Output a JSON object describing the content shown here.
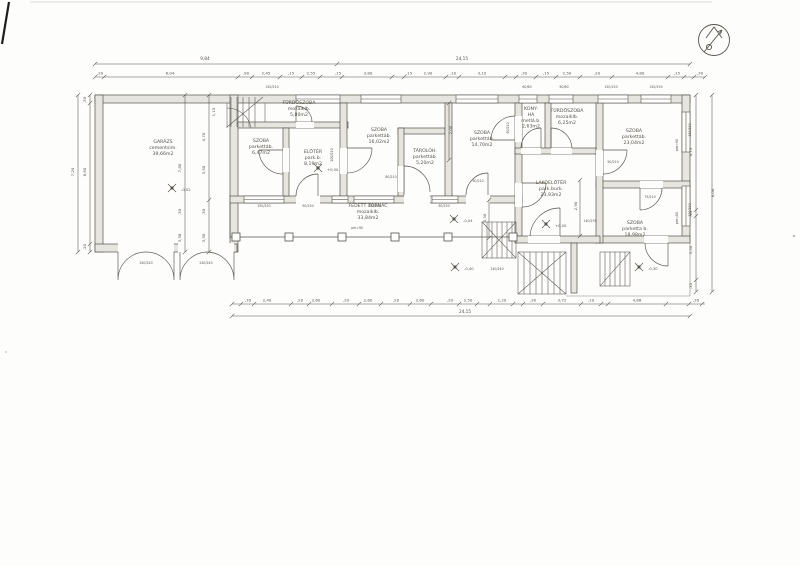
{
  "document": {
    "kind": "scanned architectural floor plan",
    "language": "hu"
  },
  "colors": {
    "ink": "#57534b",
    "ink_light": "#949087",
    "wall_fill": "#e6e5df",
    "paper": "#fdfdfc"
  },
  "compass": {
    "icon": "north-arrow"
  },
  "plan": {
    "rooms": [
      {
        "id": "garazs",
        "label": "GARÁZS\ncementsim.\n39,66m2",
        "x": 163,
        "y": 143
      },
      {
        "id": "furdoszoba1",
        "label": "FÜRDŐSZOBA\nmozaiklb.\n5,80m2",
        "x": 299,
        "y": 104
      },
      {
        "id": "szoba1",
        "label": "SZOBA\nparkettáb.\n6,47m2",
        "x": 261,
        "y": 142
      },
      {
        "id": "eloter",
        "label": "ELŐTÉR\npark.b.\n8,19m2",
        "x": 313,
        "y": 153
      },
      {
        "id": "szoba2",
        "label": "SZOBA\nparkettáb.\n16,02m2",
        "x": 379,
        "y": 131
      },
      {
        "id": "taroloh",
        "label": "TÁROLÓH.\nparkettáb.\n5,20m2",
        "x": 425,
        "y": 152
      },
      {
        "id": "szoba3",
        "label": "SZOBA\nparkettáb.\n14,70m2",
        "x": 482,
        "y": 134
      },
      {
        "id": "konyha",
        "label": "KONY-\nHA\nmetlá.b.\n2,63m2",
        "x": 531,
        "y": 110
      },
      {
        "id": "furdoszoba2",
        "label": "FÜRDŐSZOBA\nmozaiklb.\n6,25m2",
        "x": 567,
        "y": 112
      },
      {
        "id": "szoba4",
        "label": "SZOBA\nparkettáb.\n23,04m2",
        "x": 634,
        "y": 132
      },
      {
        "id": "lakoeloter",
        "label": "LAKÓELŐTÉR\npark.burk.\n23,93m2",
        "x": 551,
        "y": 184
      },
      {
        "id": "szoba5",
        "label": "SZOBA\nparketta b.\n18,98m2",
        "x": 635,
        "y": 224
      },
      {
        "id": "tornac",
        "label": "FEDETT TORNÁC\nmozaiklb.\n\n33,84m2",
        "x": 368,
        "y": 207
      }
    ],
    "levels": [
      {
        "t": "+0,00",
        "x": 326,
        "y": 170
      },
      {
        "t": "+0,00",
        "x": 554,
        "y": 226
      },
      {
        "t": "-0,04",
        "x": 462,
        "y": 221
      },
      {
        "t": "-0,40",
        "x": 463,
        "y": 269
      },
      {
        "t": "-0,30",
        "x": 647,
        "y": 269
      },
      {
        "t": "-0,02",
        "x": 180,
        "y": 190
      }
    ],
    "dim_labels": [
      {
        "t": "9,84",
        "x": 205,
        "y": 60,
        "s": 4.3
      },
      {
        "t": "24,15",
        "x": 462,
        "y": 60,
        "s": 4.3
      },
      {
        "t": ",20",
        "x": 100,
        "y": 74.5
      },
      {
        "t": "6,04",
        "x": 170,
        "y": 74.5
      },
      {
        "t": ",90",
        "x": 246,
        "y": 74.5
      },
      {
        "t": "2,45",
        "x": 266,
        "y": 74.5
      },
      {
        "t": ",15",
        "x": 291,
        "y": 74.5
      },
      {
        "t": "2,55",
        "x": 311,
        "y": 74.5
      },
      {
        "t": ",15",
        "x": 338,
        "y": 74.5
      },
      {
        "t": "3,80",
        "x": 368,
        "y": 74.5
      },
      {
        "t": ",15",
        "x": 409,
        "y": 74.5
      },
      {
        "t": "2,90",
        "x": 428,
        "y": 74.5
      },
      {
        "t": ",10",
        "x": 453,
        "y": 74.5
      },
      {
        "t": "3,10",
        "x": 482,
        "y": 74.5
      },
      {
        "t": ",30",
        "x": 524,
        "y": 74.5
      },
      {
        "t": ",15",
        "x": 546,
        "y": 74.5
      },
      {
        "t": "2,50",
        "x": 567,
        "y": 74.5
      },
      {
        "t": ",20",
        "x": 597,
        "y": 74.5
      },
      {
        "t": "4,80",
        "x": 640,
        "y": 74.5
      },
      {
        "t": ",15",
        "x": 677,
        "y": 74.5
      },
      {
        "t": ",30",
        "x": 700,
        "y": 74.5
      },
      {
        "t": ",30",
        "x": 248,
        "y": 301.5
      },
      {
        "t": "2,40",
        "x": 267,
        "y": 301.5
      },
      {
        "t": ",20",
        "x": 300,
        "y": 301.5
      },
      {
        "t": "2,60",
        "x": 316,
        "y": 301.5
      },
      {
        "t": ",20",
        "x": 346,
        "y": 301.5
      },
      {
        "t": "2,60",
        "x": 368,
        "y": 301.5
      },
      {
        "t": ",20",
        "x": 396,
        "y": 301.5
      },
      {
        "t": "2,60",
        "x": 420,
        "y": 301.5
      },
      {
        "t": ",20",
        "x": 450,
        "y": 301.5
      },
      {
        "t": "2,50",
        "x": 468,
        "y": 301.5
      },
      {
        "t": "1,20",
        "x": 502,
        "y": 301.5
      },
      {
        "t": ",30",
        "x": 533,
        "y": 301.5
      },
      {
        "t": "3,72",
        "x": 562,
        "y": 301.5
      },
      {
        "t": ",10",
        "x": 591,
        "y": 301.5
      },
      {
        "t": "4,88",
        "x": 637,
        "y": 301.5
      },
      {
        "t": ",30",
        "x": 696,
        "y": 301.5
      },
      {
        "t": "24,15",
        "x": 465,
        "y": 313,
        "s": 4.3
      },
      {
        "t": "7,20",
        "x": 74,
        "y": 172,
        "r": -90
      },
      {
        "t": ",30",
        "x": 86,
        "y": 100,
        "r": -90
      },
      {
        "t": "6,60",
        "x": 86,
        "y": 172,
        "r": -90
      },
      {
        "t": ",20",
        "x": 86,
        "y": 247,
        "r": -90
      },
      {
        "t": "8,00",
        "x": 714,
        "y": 193,
        "r": -90
      },
      {
        "t": "4,73",
        "x": 692,
        "y": 152,
        "r": -90
      },
      {
        "t": ",15",
        "x": 692,
        "y": 214,
        "r": -90
      },
      {
        "t": "3,50",
        "x": 692,
        "y": 250,
        "r": -90
      },
      {
        "t": ",35",
        "x": 692,
        "y": 286,
        "r": -90
      },
      {
        "t": "7,80",
        "x": 181,
        "y": 168,
        "r": -90
      },
      {
        "t": ",30",
        "x": 181,
        "y": 212,
        "r": -90
      },
      {
        "t": "3,38",
        "x": 181,
        "y": 238,
        "r": -90
      },
      {
        "t": "4,70",
        "x": 205,
        "y": 137,
        "r": -90
      },
      {
        "t": "3,50",
        "x": 205,
        "y": 170,
        "r": -90
      },
      {
        "t": ",30",
        "x": 205,
        "y": 212,
        "r": -90
      },
      {
        "t": "3,30",
        "x": 205,
        "y": 238,
        "r": -90
      },
      {
        "t": "1,15",
        "x": 215,
        "y": 112,
        "r": -90
      },
      {
        "t": "2,00",
        "x": 452,
        "y": 130,
        "r": -90
      },
      {
        "t": "2,90",
        "x": 577,
        "y": 206,
        "r": -90
      },
      {
        "t": "3,30",
        "x": 486,
        "y": 218,
        "r": -90
      }
    ],
    "dim_lines": [
      {
        "o": "h",
        "y": 64,
        "x1": 95,
        "x2": 690,
        "ticks": [
          95,
          337,
          690
        ]
      },
      {
        "o": "h",
        "y": 77,
        "x1": 95,
        "x2": 705,
        "ticks": [
          95,
          104,
          238,
          252,
          280,
          302,
          320,
          342,
          392,
          404,
          446,
          459,
          505,
          516,
          536,
          556,
          580,
          612,
          668,
          684,
          694,
          705
        ]
      },
      {
        "o": "h",
        "y": 304,
        "x1": 232,
        "x2": 705,
        "ticks": [
          232,
          241,
          254,
          291,
          309,
          332,
          359,
          381,
          410,
          431,
          459,
          477,
          490,
          513,
          523,
          543,
          581,
          601,
          608,
          666,
          689,
          702
        ]
      },
      {
        "o": "h",
        "y": 316,
        "x1": 232,
        "x2": 690,
        "ticks": [
          232,
          690
        ]
      },
      {
        "o": "v",
        "x": 78,
        "y1": 95,
        "y2": 252,
        "ticks": [
          95,
          252
        ]
      },
      {
        "o": "v",
        "x": 90,
        "y1": 95,
        "y2": 252,
        "ticks": [
          95,
          103,
          244,
          252
        ]
      },
      {
        "o": "v",
        "x": 712,
        "y1": 95,
        "y2": 292,
        "ticks": [
          95,
          292
        ]
      },
      {
        "o": "v",
        "x": 696,
        "y1": 95,
        "y2": 292,
        "ticks": [
          95,
          210,
          216,
          280,
          292
        ]
      },
      {
        "o": "v",
        "x": 185,
        "y1": 95,
        "y2": 252,
        "ticks": [
          95,
          252
        ]
      },
      {
        "o": "v",
        "x": 209,
        "y1": 95,
        "y2": 252,
        "ticks": [
          95,
          200,
          252
        ]
      },
      {
        "o": "v",
        "x": 449,
        "y1": 103,
        "y2": 160,
        "ticks": [
          103,
          160
        ]
      },
      {
        "o": "v",
        "x": 580,
        "y1": 180,
        "y2": 236,
        "ticks": [
          180,
          236
        ]
      },
      {
        "o": "v",
        "x": 489,
        "y1": 200,
        "y2": 238,
        "ticks": [
          200,
          238
        ]
      }
    ],
    "annotations": [
      {
        "t": "150/210",
        "x": 272,
        "y": 88
      },
      {
        "t": "60/60",
        "x": 527,
        "y": 88
      },
      {
        "t": "90/60",
        "x": 564,
        "y": 88
      },
      {
        "t": "150/150",
        "x": 611,
        "y": 88
      },
      {
        "t": "150/150",
        "x": 656,
        "y": 88
      },
      {
        "t": "150/150",
        "x": 264,
        "y": 207
      },
      {
        "t": "90/150",
        "x": 308,
        "y": 207
      },
      {
        "t": "150/150",
        "x": 374,
        "y": 207
      },
      {
        "t": "90/150",
        "x": 444,
        "y": 207
      },
      {
        "t": "240/240",
        "x": 146,
        "y": 264
      },
      {
        "t": "240/240",
        "x": 206,
        "y": 264
      },
      {
        "t": "100/210",
        "x": 333,
        "y": 155,
        "r": -90
      },
      {
        "t": "80/210",
        "x": 391,
        "y": 178
      },
      {
        "t": "90/210",
        "x": 478,
        "y": 182
      },
      {
        "t": "90/210",
        "x": 509,
        "y": 128,
        "r": -90
      },
      {
        "t": "90/210",
        "x": 613,
        "y": 163
      },
      {
        "t": "75/210",
        "x": 650,
        "y": 198
      },
      {
        "t": "140/230",
        "x": 590,
        "y": 222
      },
      {
        "t": "140/240",
        "x": 497,
        "y": 270
      },
      {
        "t": "120/230",
        "x": 691,
        "y": 210,
        "r": -90
      },
      {
        "t": "150/150",
        "x": 691,
        "y": 130,
        "r": -90
      },
      {
        "t": "pm=90",
        "x": 678,
        "y": 145,
        "r": -90
      },
      {
        "t": "pm=80",
        "x": 678,
        "y": 218,
        "r": -90
      },
      {
        "t": "pm=90",
        "x": 357,
        "y": 229
      }
    ]
  }
}
